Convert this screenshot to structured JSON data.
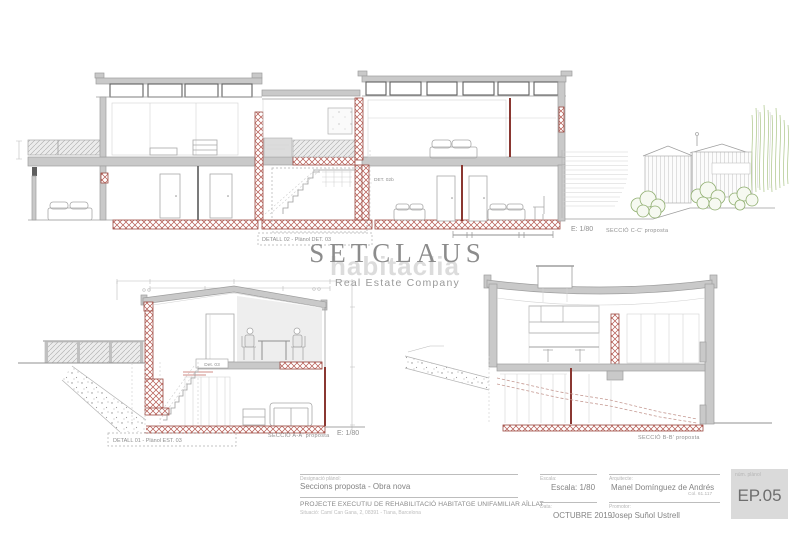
{
  "watermark": {
    "brand": "SETCLAUS",
    "background_brand": "habitaclia",
    "tagline": "Real Estate Company"
  },
  "sections": {
    "cc": {
      "detail_box_label": "DETALL 02 - Plànol DET. 03",
      "detail_ref_label": "DET. 02b",
      "scale": "E: 1/80",
      "title": "SECCIÓ C-C' proposta"
    },
    "aa": {
      "detail_box_label": "DETALL 01 - Plànol EST. 03",
      "detail_ref_label": "Det. 03",
      "title": "SECCIÓ A-A' proposta",
      "scale": "E: 1/80"
    },
    "bb": {
      "title": "SECCIÓ B-B' proposta"
    }
  },
  "title_block": {
    "designation_label": "Designació plànol:",
    "designation": "Seccions proposta - Obra nova",
    "project_title": "PROJECTE EXECUTIU DE REHABILITACIÓ HABITATGE UNIFAMILIAR AÏLLAT",
    "location": "Situació: Camí Can Gana, 2, 08391 - Tiana, Barcelona",
    "scale_label": "Escala:",
    "scale_value": "Escala: 1/80",
    "date_label": "Data:",
    "date_value": "OCTUBRE 2019",
    "architect_label": "Arquitecte:",
    "architect_name": "Manel Domínguez de Andrés",
    "architect_college": "Col. 61.117",
    "promoter_label": "Promotor:",
    "promoter_name": "Josep Suñol Ustrell",
    "sheet_label": "núm. plànol",
    "sheet_number": "EP.05"
  },
  "colors": {
    "wall_fill": "#c9c9c9",
    "line": "#9e9e9e",
    "hatch_red": "#b4564e",
    "hatch_red_border": "#9b4a42",
    "accent_dark_red": "#8a3731",
    "vegetation_green": "#8fae6f",
    "watermark_gray": "#8c8c8c"
  }
}
